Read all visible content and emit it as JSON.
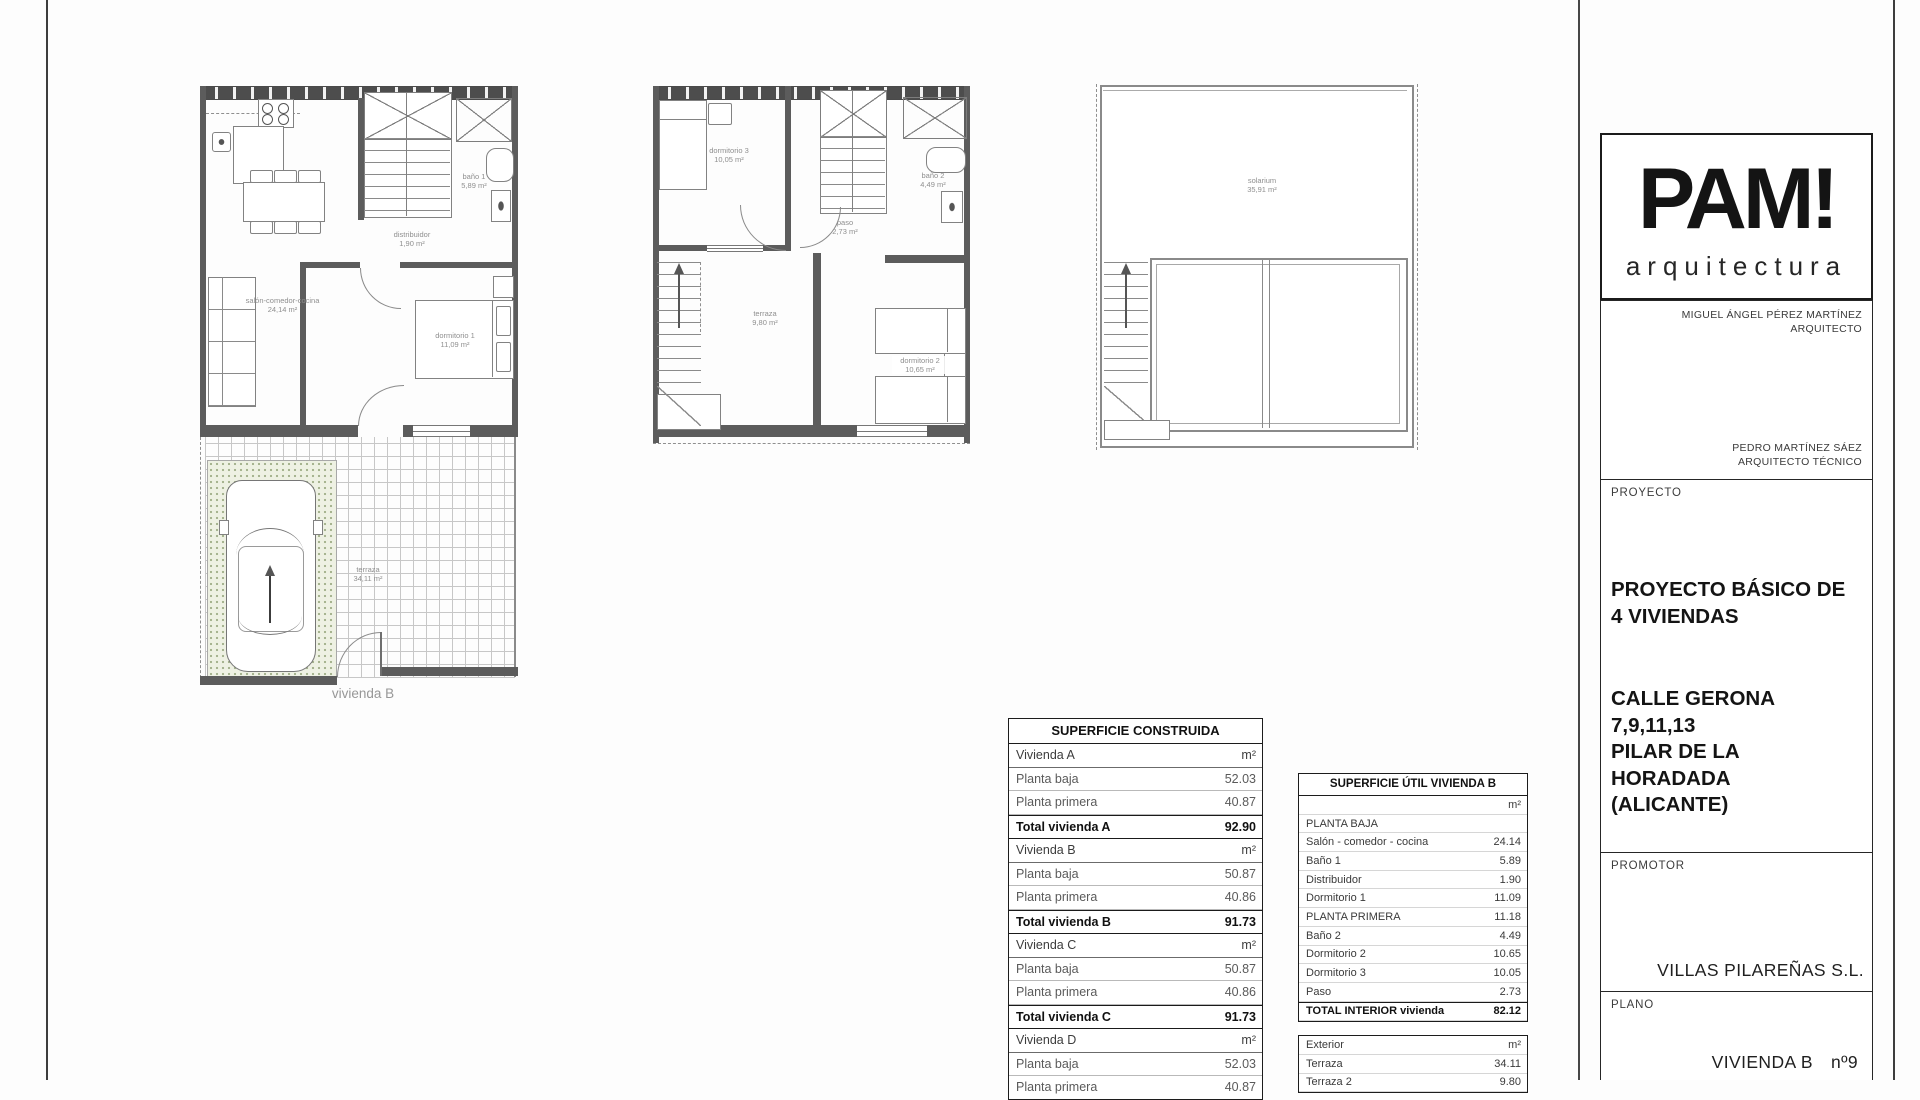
{
  "colors": {
    "ink": "#1b1b1b",
    "wall_gray": "#5c5c5c",
    "line_gray": "#8a8a8a",
    "label_gray": "#8f8f8f",
    "parking_fill": "#eef1e3"
  },
  "plans": {
    "planta_baja": {
      "caption": "vivienda B",
      "rooms": [
        {
          "name": "salón-comedor-cocina",
          "area": "24,14 m²"
        },
        {
          "name": "distribuidor",
          "area": "1,90 m²"
        },
        {
          "name": "baño 1",
          "area": "5,89 m²"
        },
        {
          "name": "dormitorio 1",
          "area": "11,09 m²"
        },
        {
          "name": "terraza",
          "area": "34,11 m²"
        }
      ]
    },
    "planta_primera": {
      "rooms": [
        {
          "name": "dormitorio 3",
          "area": "10,05 m²"
        },
        {
          "name": "baño 2",
          "area": "4,49 m²"
        },
        {
          "name": "paso",
          "area": "2,73 m²"
        },
        {
          "name": "terraza",
          "area": "9,80 m²"
        },
        {
          "name": "dormitorio 2",
          "area": "10,65 m²"
        }
      ]
    },
    "solarium": {
      "rooms": [
        {
          "name": "solarium",
          "area": "35,91 m²"
        }
      ]
    }
  },
  "tables": {
    "construida": {
      "title": "SUPERFICIE CONSTRUIDA",
      "rows": [
        {
          "label": "Vivienda A",
          "value": "m²",
          "type": "group"
        },
        {
          "label": "Planta baja",
          "value": "52.03"
        },
        {
          "label": "Planta primera",
          "value": "40.87"
        },
        {
          "label": "Total vivienda A",
          "value": "92.90",
          "type": "total"
        },
        {
          "label": "Vivienda B",
          "value": "m²",
          "type": "group"
        },
        {
          "label": "Planta baja",
          "value": "50.87"
        },
        {
          "label": "Planta primera",
          "value": "40.86"
        },
        {
          "label": "Total vivienda B",
          "value": "91.73",
          "type": "total"
        },
        {
          "label": "Vivienda C",
          "value": "m²",
          "type": "group"
        },
        {
          "label": "Planta baja",
          "value": "50.87"
        },
        {
          "label": "Planta primera",
          "value": "40.86"
        },
        {
          "label": "Total vivienda C",
          "value": "91.73",
          "type": "total"
        },
        {
          "label": "Vivienda D",
          "value": "m²",
          "type": "group"
        },
        {
          "label": "Planta baja",
          "value": "52.03"
        },
        {
          "label": "Planta primera",
          "value": "40.87"
        }
      ]
    },
    "util": {
      "title": "SUPERFICIE ÚTIL VIVIENDA B",
      "interior_rows": [
        {
          "label": "",
          "value": "m²",
          "type": "unit"
        },
        {
          "label": "PLANTA BAJA",
          "value": ""
        },
        {
          "label": "Salón - comedor - cocina",
          "value": "24.14"
        },
        {
          "label": "Baño 1",
          "value": "5.89"
        },
        {
          "label": "Distribuidor",
          "value": "1.90"
        },
        {
          "label": "Dormitorio 1",
          "value": "11.09"
        },
        {
          "label": "PLANTA PRIMERA",
          "value": "11.18"
        },
        {
          "label": "Baño 2",
          "value": "4.49"
        },
        {
          "label": "Dormitorio 2",
          "value": "10.65"
        },
        {
          "label": "Dormitorio 3",
          "value": "10.05"
        },
        {
          "label": "Paso",
          "value": "2.73"
        },
        {
          "label": "TOTAL INTERIOR vivienda",
          "value": "82.12",
          "type": "total"
        }
      ],
      "exterior_rows": [
        {
          "label": "Exterior",
          "value": "m²",
          "type": "unit"
        },
        {
          "label": "Terraza",
          "value": "34.11"
        },
        {
          "label": "Terraza 2",
          "value": "9.80"
        }
      ]
    }
  },
  "title_block": {
    "logo": {
      "name": "PAM!",
      "subtitle": "arquitectura"
    },
    "architects": [
      {
        "name": "MIGUEL ÁNGEL PÉREZ MARTÍNEZ",
        "role": "ARQUITECTO"
      },
      {
        "name": "PEDRO MARTÍNEZ SÁEZ",
        "role": "ARQUITECTO TÉCNICO"
      }
    ],
    "proyecto": {
      "label": "PROYECTO",
      "title_lines": [
        "PROYECTO BÁSICO DE",
        "4 VIVIENDAS"
      ],
      "address_lines": [
        "CALLE GERONA",
        "7,9,11,13",
        "PILAR DE LA HORADADA",
        "(ALICANTE)"
      ]
    },
    "promotor": {
      "label": "PROMOTOR",
      "name": "VILLAS PILAREÑAS S.L."
    },
    "plano": {
      "label": "PLANO",
      "name": "VIVIENDA B",
      "number": "nº9"
    }
  }
}
